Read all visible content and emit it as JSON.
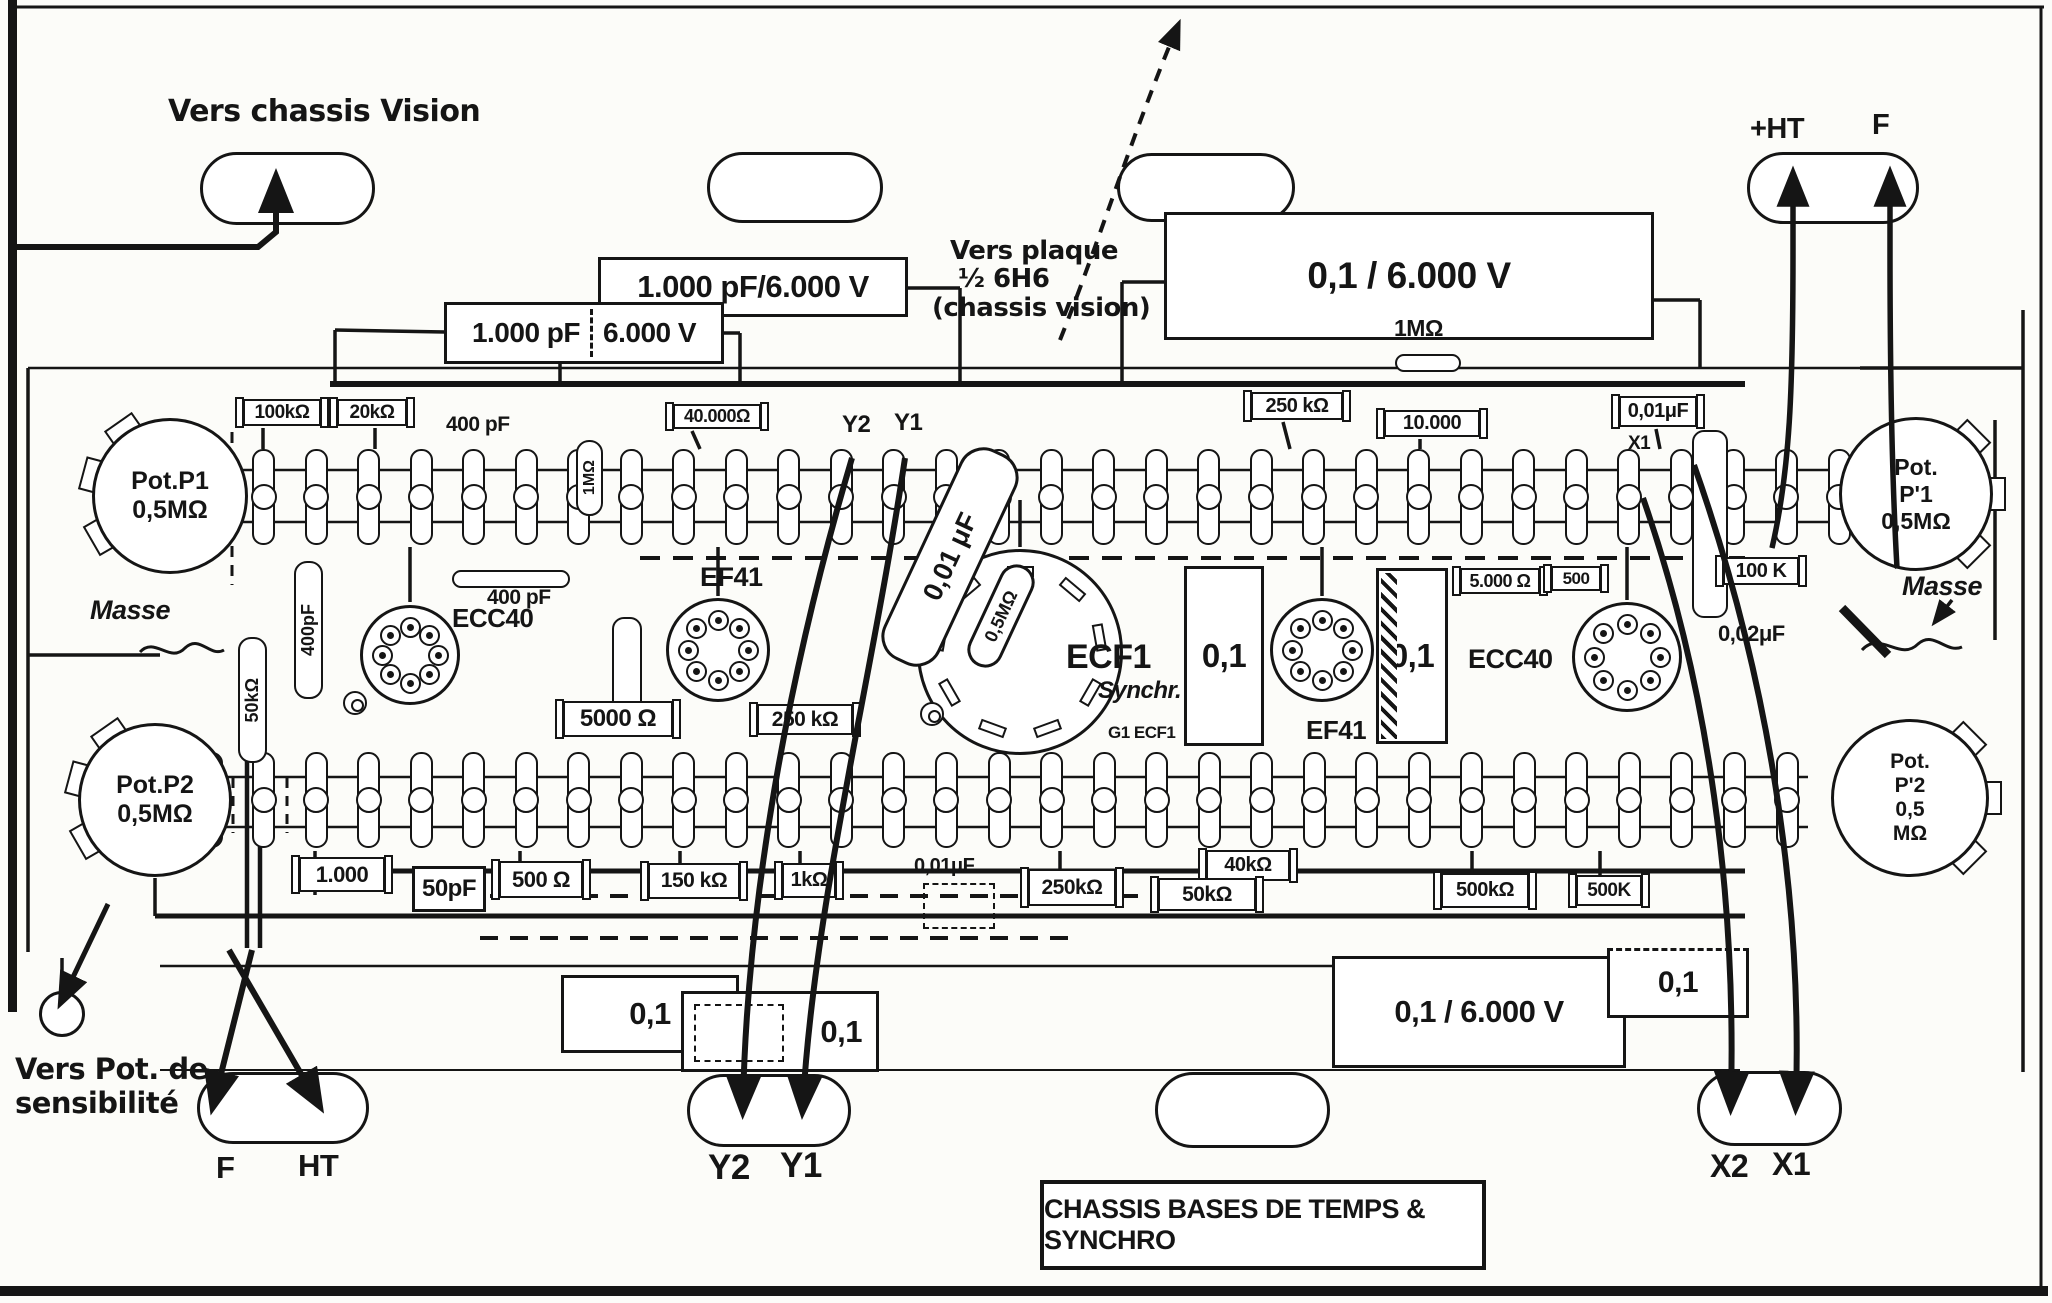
{
  "title": {
    "text": "CHASSIS BASES DE TEMPS & SYNCHRO"
  },
  "colors": {
    "ink": "#151515",
    "paper": "#fcfcf9"
  },
  "labels": [
    {
      "n": "annotation-vers-chassis-vision",
      "t": "Vers chassis Vision",
      "x": 168,
      "y": 96,
      "fs": 30,
      "cls": "script"
    },
    {
      "n": "annotation-vers-plaque-line1",
      "t": "Vers plaque",
      "x": 950,
      "y": 238,
      "fs": 26,
      "cls": "script"
    },
    {
      "n": "annotation-vers-plaque-line2",
      "t": "½ 6H6",
      "x": 958,
      "y": 266,
      "fs": 26,
      "cls": "script"
    },
    {
      "n": "annotation-vers-plaque-line3",
      "t": "(chassis vision)",
      "x": 932,
      "y": 295,
      "fs": 26,
      "cls": "script"
    },
    {
      "n": "annotation-vers-pot-line1",
      "t": "Vers Pot. de",
      "x": 15,
      "y": 1054,
      "fs": 29,
      "cls": "script"
    },
    {
      "n": "annotation-vers-pot-line2",
      "t": "sensibilité",
      "x": 15,
      "y": 1088,
      "fs": 29,
      "cls": "script"
    },
    {
      "n": "label-plus-ht",
      "t": "+HT",
      "x": 1750,
      "y": 114,
      "fs": 29
    },
    {
      "n": "label-f-top",
      "t": "F",
      "x": 1872,
      "y": 110,
      "fs": 29
    },
    {
      "n": "label-masse-left",
      "t": "Masse",
      "x": 90,
      "y": 596,
      "fs": 27,
      "cls": "ital"
    },
    {
      "n": "label-masse-right",
      "t": "Masse",
      "x": 1902,
      "y": 572,
      "fs": 27,
      "cls": "ital"
    },
    {
      "n": "label-y2-top",
      "t": "Y2",
      "x": 842,
      "y": 412,
      "fs": 24
    },
    {
      "n": "label-y1-top",
      "t": "Y1",
      "x": 894,
      "y": 410,
      "fs": 24
    },
    {
      "n": "label-x1-top",
      "t": "X1",
      "x": 1628,
      "y": 434,
      "fs": 19
    },
    {
      "n": "label-1mohm-top",
      "t": "1MΩ",
      "x": 1394,
      "y": 316,
      "fs": 23
    },
    {
      "n": "label-400pf-top",
      "t": "400 pF",
      "x": 446,
      "y": 414,
      "fs": 21
    },
    {
      "n": "label-400pf-mid",
      "t": "400 pF",
      "x": 487,
      "y": 587,
      "fs": 21
    },
    {
      "n": "label-002uf",
      "t": "0,02μF",
      "x": 1718,
      "y": 622,
      "fs": 22
    },
    {
      "n": "label-001uf-bottom",
      "t": "0,01μF.",
      "x": 914,
      "y": 856,
      "fs": 20
    },
    {
      "n": "label-synchr",
      "t": "Synchr.",
      "x": 1098,
      "y": 678,
      "fs": 24,
      "cls": "ital"
    },
    {
      "n": "label-g1-ecf1",
      "t": "G1 ECF1",
      "x": 1108,
      "y": 724,
      "fs": 17
    },
    {
      "n": "label-f-bottom",
      "t": "F",
      "x": 216,
      "y": 1152,
      "fs": 31
    },
    {
      "n": "label-ht-bottom",
      "t": "HT",
      "x": 298,
      "y": 1150,
      "fs": 31
    },
    {
      "n": "label-y2-bottom",
      "t": "Y2",
      "x": 708,
      "y": 1150,
      "fs": 35
    },
    {
      "n": "label-y1-bottom",
      "t": "Y1",
      "x": 780,
      "y": 1148,
      "fs": 35
    },
    {
      "n": "label-x2-bottom",
      "t": "X2",
      "x": 1710,
      "y": 1150,
      "fs": 32
    },
    {
      "n": "label-x1-bottom",
      "t": "X1",
      "x": 1772,
      "y": 1148,
      "fs": 32
    }
  ],
  "boxes": [
    {
      "n": "component-100kohm",
      "t": "100kΩ",
      "x": 243,
      "y": 399,
      "w": 78,
      "h": 27,
      "fs": 19,
      "cls": "res"
    },
    {
      "n": "component-20kohm",
      "t": "20kΩ",
      "x": 337,
      "y": 399,
      "w": 70,
      "h": 27,
      "fs": 19,
      "cls": "res"
    },
    {
      "n": "component-40000ohm",
      "t": "40.000Ω",
      "x": 673,
      "y": 404,
      "w": 88,
      "h": 25,
      "fs": 18,
      "cls": "res"
    },
    {
      "n": "component-250kohm-top",
      "t": "250 kΩ",
      "x": 1251,
      "y": 392,
      "w": 92,
      "h": 28,
      "fs": 20,
      "cls": "res"
    },
    {
      "n": "component-10000",
      "t": "10.000",
      "x": 1384,
      "y": 410,
      "w": 96,
      "h": 27,
      "fs": 20,
      "cls": "res"
    },
    {
      "n": "component-001uf-topright",
      "t": "0,01μF",
      "x": 1619,
      "y": 396,
      "w": 78,
      "h": 31,
      "fs": 20,
      "cls": "res"
    },
    {
      "n": "capacitor-1000pf-6000v",
      "t": "1.000 pF/6.000 V",
      "x": 598,
      "y": 257,
      "w": 310,
      "h": 60,
      "fs": 31,
      "cls": "big"
    },
    {
      "n": "capacitor-1000pf-6000v-split",
      "t": "1.000 pF",
      "t2": "6.000 V",
      "x": 444,
      "y": 302,
      "w": 280,
      "h": 62,
      "fs": 28,
      "cls": "big split"
    },
    {
      "n": "capacitor-01-6000v-top",
      "t": "0,1 / 6.000 V",
      "x": 1164,
      "y": 212,
      "w": 490,
      "h": 128,
      "fs": 37,
      "cls": "big"
    },
    {
      "n": "component-5000ohm-right",
      "t": "5.000 Ω",
      "x": 1460,
      "y": 568,
      "w": 80,
      "h": 26,
      "fs": 18,
      "cls": "res"
    },
    {
      "n": "component-500-right",
      "t": "500",
      "x": 1551,
      "y": 566,
      "w": 50,
      "h": 25,
      "fs": 17,
      "cls": "res"
    },
    {
      "n": "component-100k-right",
      "t": "100 K",
      "x": 1723,
      "y": 557,
      "w": 76,
      "h": 28,
      "fs": 20,
      "cls": "res"
    },
    {
      "n": "component-5000ohm-left",
      "t": "5000 Ω",
      "x": 563,
      "y": 701,
      "w": 110,
      "h": 36,
      "fs": 24,
      "cls": "res"
    },
    {
      "n": "component-250kohm-mid",
      "t": "250 kΩ",
      "x": 757,
      "y": 704,
      "w": 96,
      "h": 31,
      "fs": 21,
      "cls": "res"
    },
    {
      "n": "component-1000-bottom",
      "t": "1.000",
      "x": 299,
      "y": 857,
      "w": 86,
      "h": 35,
      "fs": 22,
      "cls": "res"
    },
    {
      "n": "component-50pf",
      "t": "50pF",
      "x": 412,
      "y": 866,
      "w": 74,
      "h": 46,
      "fs": 24,
      "cls": "big"
    },
    {
      "n": "component-500ohm-bottom",
      "t": "500 Ω",
      "x": 499,
      "y": 861,
      "w": 84,
      "h": 37,
      "fs": 22,
      "cls": "res"
    },
    {
      "n": "component-150kohm",
      "t": "150 kΩ",
      "x": 648,
      "y": 863,
      "w": 92,
      "h": 36,
      "fs": 21,
      "cls": "res"
    },
    {
      "n": "component-1kohm",
      "t": "1kΩ",
      "x": 782,
      "y": 863,
      "w": 54,
      "h": 35,
      "fs": 20,
      "cls": "res"
    },
    {
      "n": "component-250kohm-bottom",
      "t": "250kΩ",
      "x": 1028,
      "y": 869,
      "w": 88,
      "h": 37,
      "fs": 21,
      "cls": "res"
    },
    {
      "n": "component-40kohm",
      "t": "40kΩ",
      "x": 1206,
      "y": 850,
      "w": 84,
      "h": 31,
      "fs": 20,
      "cls": "res"
    },
    {
      "n": "component-50kohm-bottom",
      "t": "50kΩ",
      "x": 1158,
      "y": 878,
      "w": 98,
      "h": 33,
      "fs": 21,
      "cls": "res"
    },
    {
      "n": "component-500kohm",
      "t": "500kΩ",
      "x": 1441,
      "y": 873,
      "w": 88,
      "h": 35,
      "fs": 20,
      "cls": "res"
    },
    {
      "n": "component-500k",
      "t": "500K",
      "x": 1576,
      "y": 875,
      "w": 66,
      "h": 31,
      "fs": 19,
      "cls": "res"
    },
    {
      "n": "capacitor-01-box1",
      "t": "0,1",
      "x": 561,
      "y": 975,
      "w": 178,
      "h": 78,
      "fs": 31,
      "cls": "big"
    },
    {
      "n": "capacitor-01-box2",
      "t": "0,1",
      "x": 681,
      "y": 991,
      "w": 198,
      "h": 81,
      "fs": 31,
      "cls": "big dashIn",
      "ta": "right"
    },
    {
      "n": "capacitor-01-6000v-bottom",
      "t": "0,1 / 6.000 V",
      "x": 1332,
      "y": 956,
      "w": 294,
      "h": 112,
      "fs": 31,
      "cls": "big"
    },
    {
      "n": "capacitor-01-bottomright",
      "t": "0,1",
      "x": 1607,
      "y": 948,
      "w": 142,
      "h": 70,
      "fs": 30,
      "cls": "big dashTop"
    },
    {
      "n": "capacitor-01-vert1",
      "t": "0,1",
      "x": 1184,
      "y": 566,
      "w": 80,
      "h": 180,
      "fs": 33,
      "cls": "big"
    },
    {
      "n": "capacitor-01-vert2",
      "t": "0,1",
      "x": 1376,
      "y": 568,
      "w": 72,
      "h": 176,
      "fs": 33,
      "cls": "big hatchL"
    },
    {
      "n": "capacitor-dashed-001uf",
      "t": "",
      "x": 923,
      "y": 883,
      "w": 72,
      "h": 46,
      "fs": 10,
      "cls": "dcap"
    },
    {
      "n": "title-box",
      "t": "CHASSIS BASES DE TEMPS & SYNCHRO",
      "x": 1040,
      "y": 1180,
      "w": 446,
      "h": 90,
      "fs": 27,
      "cls": "titlebox"
    }
  ],
  "pills": [
    {
      "n": "resistor-1mohm-body",
      "x": 1395,
      "y": 354,
      "w": 66,
      "h": 18
    },
    {
      "n": "resistor-400pf-body",
      "x": 452,
      "y": 570,
      "w": 118,
      "h": 18
    },
    {
      "n": "capacitor-body-unlabeled",
      "x": 612,
      "y": 617,
      "w": 30,
      "h": 118
    },
    {
      "n": "capacitor-002uf-body",
      "x": 1692,
      "y": 430,
      "w": 36,
      "h": 188
    }
  ],
  "vcomps": [
    {
      "n": "component-1mohm-vertical",
      "t": "1MΩ",
      "x": 576,
      "y": 440,
      "w": 27,
      "h": 76,
      "fs": 16
    },
    {
      "n": "component-50kohm-vertical",
      "t": "50kΩ",
      "x": 238,
      "y": 637,
      "w": 29,
      "h": 126,
      "fs": 18
    },
    {
      "n": "component-400pf-vertical",
      "t": "400pF",
      "x": 294,
      "y": 561,
      "w": 29,
      "h": 138,
      "fs": 18
    }
  ],
  "dcomps": [
    {
      "n": "capacitor-001uf-diagonal",
      "t": "0,01 μF",
      "cx": 950,
      "cy": 557,
      "w": 62,
      "h": 232,
      "rot": 25,
      "fs": 27
    },
    {
      "n": "resistor-05mohm-diagonal",
      "t": "0,5MΩ",
      "cx": 1001,
      "cy": 616,
      "w": 36,
      "h": 110,
      "rot": 25,
      "fs": 18
    }
  ],
  "ovals": [
    {
      "n": "hole-top-left",
      "x": 200,
      "y": 152,
      "w": 175,
      "h": 73
    },
    {
      "n": "hole-top-midleft",
      "x": 707,
      "y": 152,
      "w": 176,
      "h": 71
    },
    {
      "n": "hole-top-midright",
      "x": 1117,
      "y": 153,
      "w": 178,
      "h": 69
    },
    {
      "n": "hole-top-right",
      "x": 1747,
      "y": 152,
      "w": 172,
      "h": 72
    },
    {
      "n": "hole-bottom-left",
      "x": 197,
      "y": 1072,
      "w": 172,
      "h": 72
    },
    {
      "n": "hole-bottom-center",
      "x": 687,
      "y": 1074,
      "w": 164,
      "h": 73
    },
    {
      "n": "hole-bottom-midright",
      "x": 1155,
      "y": 1072,
      "w": 175,
      "h": 76
    },
    {
      "n": "hole-bottom-right",
      "x": 1697,
      "y": 1071,
      "w": 145,
      "h": 75
    }
  ],
  "sockets": [
    {
      "n": "tube-ecc40-left",
      "t": "ECC40",
      "lx": 452,
      "ly": 605,
      "lfs": 26,
      "cx": 410,
      "cy": 655,
      "r": 50,
      "pins": 8
    },
    {
      "n": "tube-ef41-left",
      "t": "EF41",
      "lx": 700,
      "ly": 563,
      "lfs": 27,
      "cx": 718,
      "cy": 650,
      "r": 52,
      "pins": 8
    },
    {
      "n": "tube-ecf1",
      "t": "ECF1",
      "lx": 1066,
      "ly": 640,
      "lfs": 34,
      "cx": 1020,
      "cy": 652,
      "r": 103,
      "pins": 9,
      "slots": true
    },
    {
      "n": "tube-ef41-right",
      "t": "EF41",
      "lx": 1306,
      "ly": 717,
      "lfs": 26,
      "cx": 1322,
      "cy": 650,
      "r": 52,
      "pins": 8
    },
    {
      "n": "tube-ecc40-right",
      "t": "ECC40",
      "lx": 1468,
      "ly": 645,
      "lfs": 27,
      "cx": 1627,
      "cy": 657,
      "r": 55,
      "pins": 8
    }
  ],
  "pots": [
    {
      "n": "pot-p1",
      "lines": [
        "Pot.P1",
        "0,5MΩ"
      ],
      "cx": 170,
      "cy": 496,
      "r": 78,
      "fs": 25,
      "tabs": [
        150,
        195,
        235
      ]
    },
    {
      "n": "pot-p2",
      "lines": [
        "Pot.P2",
        "0,5MΩ"
      ],
      "cx": 155,
      "cy": 800,
      "r": 77,
      "fs": 25,
      "tabs": [
        150,
        195,
        235
      ]
    },
    {
      "n": "pot-p1-prime",
      "lines": [
        "Pot.",
        "P'1",
        "0,5MΩ"
      ],
      "cx": 1916,
      "cy": 494,
      "r": 77,
      "fs": 23,
      "tabs": [
        -45,
        0,
        45
      ]
    },
    {
      "n": "pot-p2-prime",
      "lines": [
        "Pot.",
        "P'2",
        "0,5",
        "MΩ"
      ],
      "cx": 1910,
      "cy": 798,
      "r": 79,
      "fs": 21,
      "tabs": [
        -45,
        0,
        45
      ]
    }
  ],
  "strips": [
    {
      "n": "terminal-strip-upper",
      "x1": 211,
      "x2": 1839,
      "count": 32,
      "cy": 497,
      "lugH": 96
    },
    {
      "n": "terminal-strip-lower",
      "x1": 211,
      "x2": 1787,
      "count": 31,
      "cy": 800,
      "lugH": 96
    }
  ],
  "targets": [
    {
      "n": "mount-target-1",
      "cx": 355,
      "cy": 703
    },
    {
      "n": "mount-target-2",
      "cx": 932,
      "cy": 714
    }
  ],
  "circles": [
    {
      "n": "hole-sensibilite",
      "cx": 62,
      "cy": 1014,
      "r": 23
    }
  ]
}
